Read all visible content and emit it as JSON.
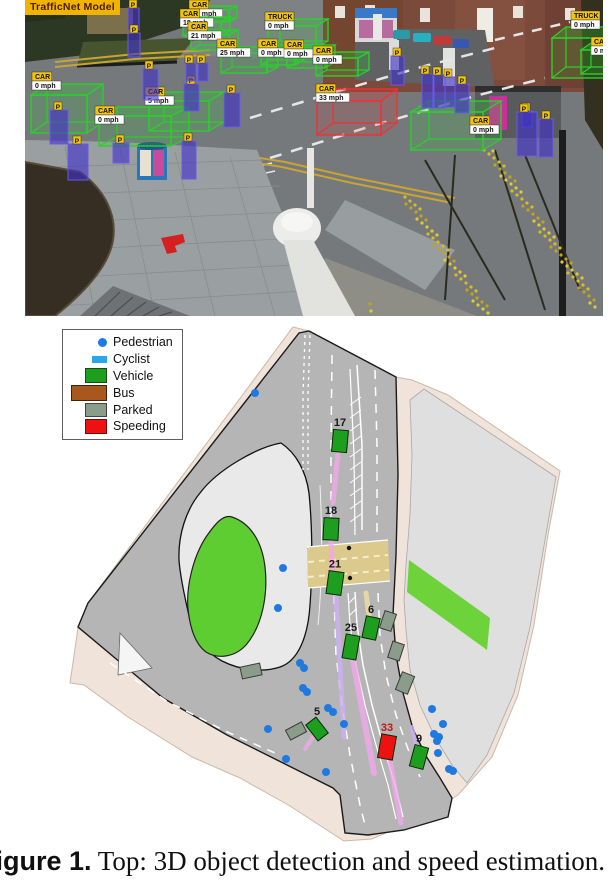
{
  "figure": {
    "caption_bold": "Figure 1.",
    "caption_text": " Top: 3D object detection and speed estimation."
  },
  "photo": {
    "model_label": "TrafficNet Model",
    "ped_label": "P",
    "vehicle_boxes": [
      {
        "label": "CAR",
        "speed": "17 mph",
        "x": 170,
        "y": 10,
        "w": 34,
        "h": 12,
        "dx": 8,
        "dy": -4,
        "lx": 164,
        "ly": 0
      },
      {
        "label": "CAR",
        "speed": "18 mph",
        "x": 158,
        "y": 22,
        "w": 38,
        "h": 14,
        "dx": 9,
        "dy": -5,
        "lx": 155,
        "ly": 9
      },
      {
        "label": "CAR",
        "speed": "21 mph",
        "x": 166,
        "y": 35,
        "w": 38,
        "h": 15,
        "dx": 9,
        "dy": -5,
        "lx": 163,
        "ly": 22
      },
      {
        "label": "CAR",
        "speed": "25 mph",
        "x": 196,
        "y": 53,
        "w": 46,
        "h": 20,
        "dx": 11,
        "dy": -6,
        "lx": 192,
        "ly": 39
      },
      {
        "label": "TRUCK",
        "speed": "0 mph",
        "x": 243,
        "y": 26,
        "w": 48,
        "h": 22,
        "dx": 12,
        "dy": -7,
        "lx": 240,
        "ly": 12
      },
      {
        "label": "CAR",
        "speed": "0 mph",
        "x": 236,
        "y": 50,
        "w": 34,
        "h": 15,
        "dx": 9,
        "dy": -5,
        "lx": 233,
        "ly": 39
      },
      {
        "label": "CAR",
        "speed": "0 mph",
        "x": 262,
        "y": 51,
        "w": 38,
        "h": 17,
        "dx": 10,
        "dy": -6,
        "lx": 259,
        "ly": 40
      },
      {
        "label": "CAR",
        "speed": "0 mph",
        "x": 291,
        "y": 58,
        "w": 42,
        "h": 18,
        "dx": 11,
        "dy": -6,
        "lx": 288,
        "ly": 46
      },
      {
        "label": "CAR",
        "speed": "0 mph",
        "x": 6,
        "y": 95,
        "w": 56,
        "h": 38,
        "dx": 16,
        "dy": -11,
        "lx": 7,
        "ly": 72
      },
      {
        "label": "CAR",
        "speed": "0 mph",
        "x": 74,
        "y": 116,
        "w": 72,
        "h": 30,
        "dx": 18,
        "dy": -9,
        "lx": 70,
        "ly": 106
      },
      {
        "label": "CAR",
        "speed": "5 mph",
        "x": 124,
        "y": 101,
        "w": 60,
        "h": 30,
        "dx": 15,
        "dy": -9,
        "lx": 120,
        "ly": 87
      },
      {
        "label": "CAR",
        "speed": "0 mph",
        "x": 386,
        "y": 112,
        "w": 72,
        "h": 38,
        "dx": 18,
        "dy": -11,
        "lx": 445,
        "ly": 116
      },
      {
        "label": "CAR",
        "speed": "33 mph",
        "x": 292,
        "y": 101,
        "w": 64,
        "h": 34,
        "dx": 16,
        "dy": -12,
        "lx": 291,
        "ly": 84,
        "speeding": true
      },
      {
        "label": "TRUCK",
        "speed": "0 mph",
        "x": 527,
        "y": 38,
        "w": 58,
        "h": 40,
        "dx": 14,
        "dy": -11,
        "lx": 546,
        "ly": 11
      },
      {
        "label": "CAR",
        "speed": "0 mph",
        "x": 556,
        "y": 50,
        "w": 34,
        "h": 24,
        "dx": 10,
        "dy": -7,
        "lx": 566,
        "ly": 37
      }
    ],
    "ped_boxes": [
      {
        "x": 103,
        "y": 8,
        "w": 11,
        "h": 22,
        "tx": 104,
        "ty": 0
      },
      {
        "x": 103,
        "y": 33,
        "w": 12,
        "h": 24,
        "tx": 105,
        "ty": 25
      },
      {
        "x": 25,
        "y": 110,
        "w": 18,
        "h": 34,
        "tx": 29,
        "ty": 102
      },
      {
        "x": 43,
        "y": 144,
        "w": 20,
        "h": 36,
        "tx": 48,
        "ty": 136
      },
      {
        "x": 88,
        "y": 143,
        "w": 16,
        "h": 20,
        "tx": 91,
        "ty": 135
      },
      {
        "x": 118,
        "y": 69,
        "w": 15,
        "h": 31,
        "tx": 120,
        "ty": 61
      },
      {
        "x": 159,
        "y": 84,
        "w": 15,
        "h": 27,
        "tx": 162,
        "ty": 76
      },
      {
        "x": 161,
        "y": 63,
        "w": 10,
        "h": 18,
        "tx": 160,
        "ty": 55
      },
      {
        "x": 173,
        "y": 63,
        "w": 10,
        "h": 18,
        "tx": 172,
        "ty": 55
      },
      {
        "x": 199,
        "y": 93,
        "w": 16,
        "h": 34,
        "tx": 202,
        "ty": 85
      },
      {
        "x": 157,
        "y": 141,
        "w": 14,
        "h": 38,
        "tx": 159,
        "ty": 133
      },
      {
        "x": 366,
        "y": 56,
        "w": 13,
        "h": 29,
        "tx": 368,
        "ty": 48
      },
      {
        "x": 397,
        "y": 74,
        "w": 11,
        "h": 34,
        "tx": 396,
        "ty": 66
      },
      {
        "x": 409,
        "y": 75,
        "w": 11,
        "h": 33,
        "tx": 408,
        "ty": 67
      },
      {
        "x": 420,
        "y": 77,
        "w": 10,
        "h": 30,
        "tx": 419,
        "ty": 69
      },
      {
        "x": 430,
        "y": 84,
        "w": 14,
        "h": 29,
        "tx": 433,
        "ty": 76
      },
      {
        "x": 497,
        "y": 111,
        "w": 10,
        "h": 16,
        "tx": 497,
        "ty": 103
      },
      {
        "x": 514,
        "y": 119,
        "w": 14,
        "h": 38,
        "tx": 517,
        "ty": 111
      },
      {
        "x": 492,
        "y": 112,
        "w": 20,
        "h": 44,
        "tx": 495,
        "ty": 104
      }
    ]
  },
  "map": {
    "legend": [
      {
        "label": "Pedestrian",
        "type": "dot",
        "color": "#1f7ae0"
      },
      {
        "label": "Cyclist",
        "type": "rect-small",
        "color": "#2aa7e8"
      },
      {
        "label": "Vehicle",
        "type": "rect",
        "color": "#1e9e1e"
      },
      {
        "label": "Bus",
        "type": "rect-wide",
        "color": "#a8581e"
      },
      {
        "label": "Parked",
        "type": "rect-parked",
        "color": "#8a9d8a"
      },
      {
        "label": "Speeding",
        "type": "rect-red",
        "color": "#ee1111"
      }
    ],
    "vehicles": [
      {
        "n": "17",
        "x": 340,
        "y": 116,
        "w": 15,
        "h": 22,
        "rot": 5
      },
      {
        "n": "18",
        "x": 331,
        "y": 204,
        "w": 15,
        "h": 22,
        "rot": 3
      },
      {
        "n": "21",
        "x": 335,
        "y": 258,
        "w": 15,
        "h": 23,
        "rot": 8
      },
      {
        "n": "25",
        "x": 351,
        "y": 322,
        "w": 14,
        "h": 24,
        "rot": 10
      },
      {
        "n": "6",
        "x": 371,
        "y": 303,
        "w": 14,
        "h": 22,
        "rot": 12
      },
      {
        "n": "5",
        "x": 317,
        "y": 404,
        "w": 13,
        "h": 20,
        "rot": -38
      },
      {
        "n": "9",
        "x": 419,
        "y": 432,
        "w": 14,
        "h": 22,
        "rot": 15
      },
      {
        "n": "33",
        "x": 387,
        "y": 422,
        "w": 15,
        "h": 24,
        "rot": 10,
        "speeding": true
      }
    ],
    "trails": [
      {
        "x1": 338,
        "y1": 128,
        "x2": 333,
        "y2": 178,
        "c": "pink",
        "w": 5
      },
      {
        "x1": 331,
        "y1": 216,
        "x2": 333,
        "y2": 250,
        "c": "pink",
        "w": 5
      },
      {
        "x1": 336,
        "y1": 270,
        "x2": 344,
        "y2": 412,
        "c": "violet",
        "w": 5
      },
      {
        "x1": 353,
        "y1": 335,
        "x2": 374,
        "y2": 448,
        "c": "pink",
        "w": 6
      },
      {
        "x1": 369,
        "y1": 291,
        "x2": 366,
        "y2": 268,
        "c": "yellow",
        "w": 5
      },
      {
        "x1": 313,
        "y1": 412,
        "x2": 305,
        "y2": 424,
        "c": "pink",
        "w": 4
      },
      {
        "x1": 416,
        "y1": 420,
        "x2": 412,
        "y2": 402,
        "c": "violet",
        "w": 4
      },
      {
        "x1": 390,
        "y1": 435,
        "x2": 401,
        "y2": 498,
        "c": "pink",
        "w": 5
      }
    ],
    "parked": [
      {
        "x": 388,
        "y": 296,
        "w": 12,
        "h": 18,
        "rot": 18
      },
      {
        "x": 396,
        "y": 326,
        "w": 12,
        "h": 17,
        "rot": 18
      },
      {
        "x": 405,
        "y": 358,
        "w": 13,
        "h": 19,
        "rot": 22
      },
      {
        "x": 251,
        "y": 346,
        "w": 20,
        "h": 12,
        "rot": -12
      },
      {
        "x": 296,
        "y": 406,
        "w": 18,
        "h": 11,
        "rot": -28
      }
    ],
    "pedestrians": [
      [
        255,
        68
      ],
      [
        283,
        243
      ],
      [
        278,
        283
      ],
      [
        300,
        338
      ],
      [
        304,
        343
      ],
      [
        303,
        363
      ],
      [
        307,
        367
      ],
      [
        328,
        383
      ],
      [
        333,
        387
      ],
      [
        344,
        399
      ],
      [
        268,
        404
      ],
      [
        286,
        434
      ],
      [
        326,
        447
      ],
      [
        432,
        384
      ],
      [
        443,
        399
      ],
      [
        434,
        409
      ],
      [
        439,
        412
      ],
      [
        437,
        416
      ],
      [
        438,
        428
      ],
      [
        449,
        444
      ],
      [
        453,
        446
      ]
    ],
    "crossing_dots": [
      [
        349,
        223
      ],
      [
        350,
        253
      ]
    ]
  },
  "colors": {
    "vehicle_box": "#2ad12a",
    "speeding_box": "#f23030",
    "pedestrian_box": "#4030c8",
    "tag_yellow": "#f2c40c",
    "map_vehicle": "#1e9e1e",
    "map_parked": "#8a9d8a",
    "map_speeding": "#ee1111",
    "map_pedestrian": "#1f7ae0",
    "trail_pink": "#f2a8ec",
    "trail_violet": "#cdb0f2",
    "trail_yellow": "#f0e0a0",
    "crossing": "#dcc98c",
    "number_label": "#1a1a1a",
    "number_label_speeding": "#cc1111"
  }
}
